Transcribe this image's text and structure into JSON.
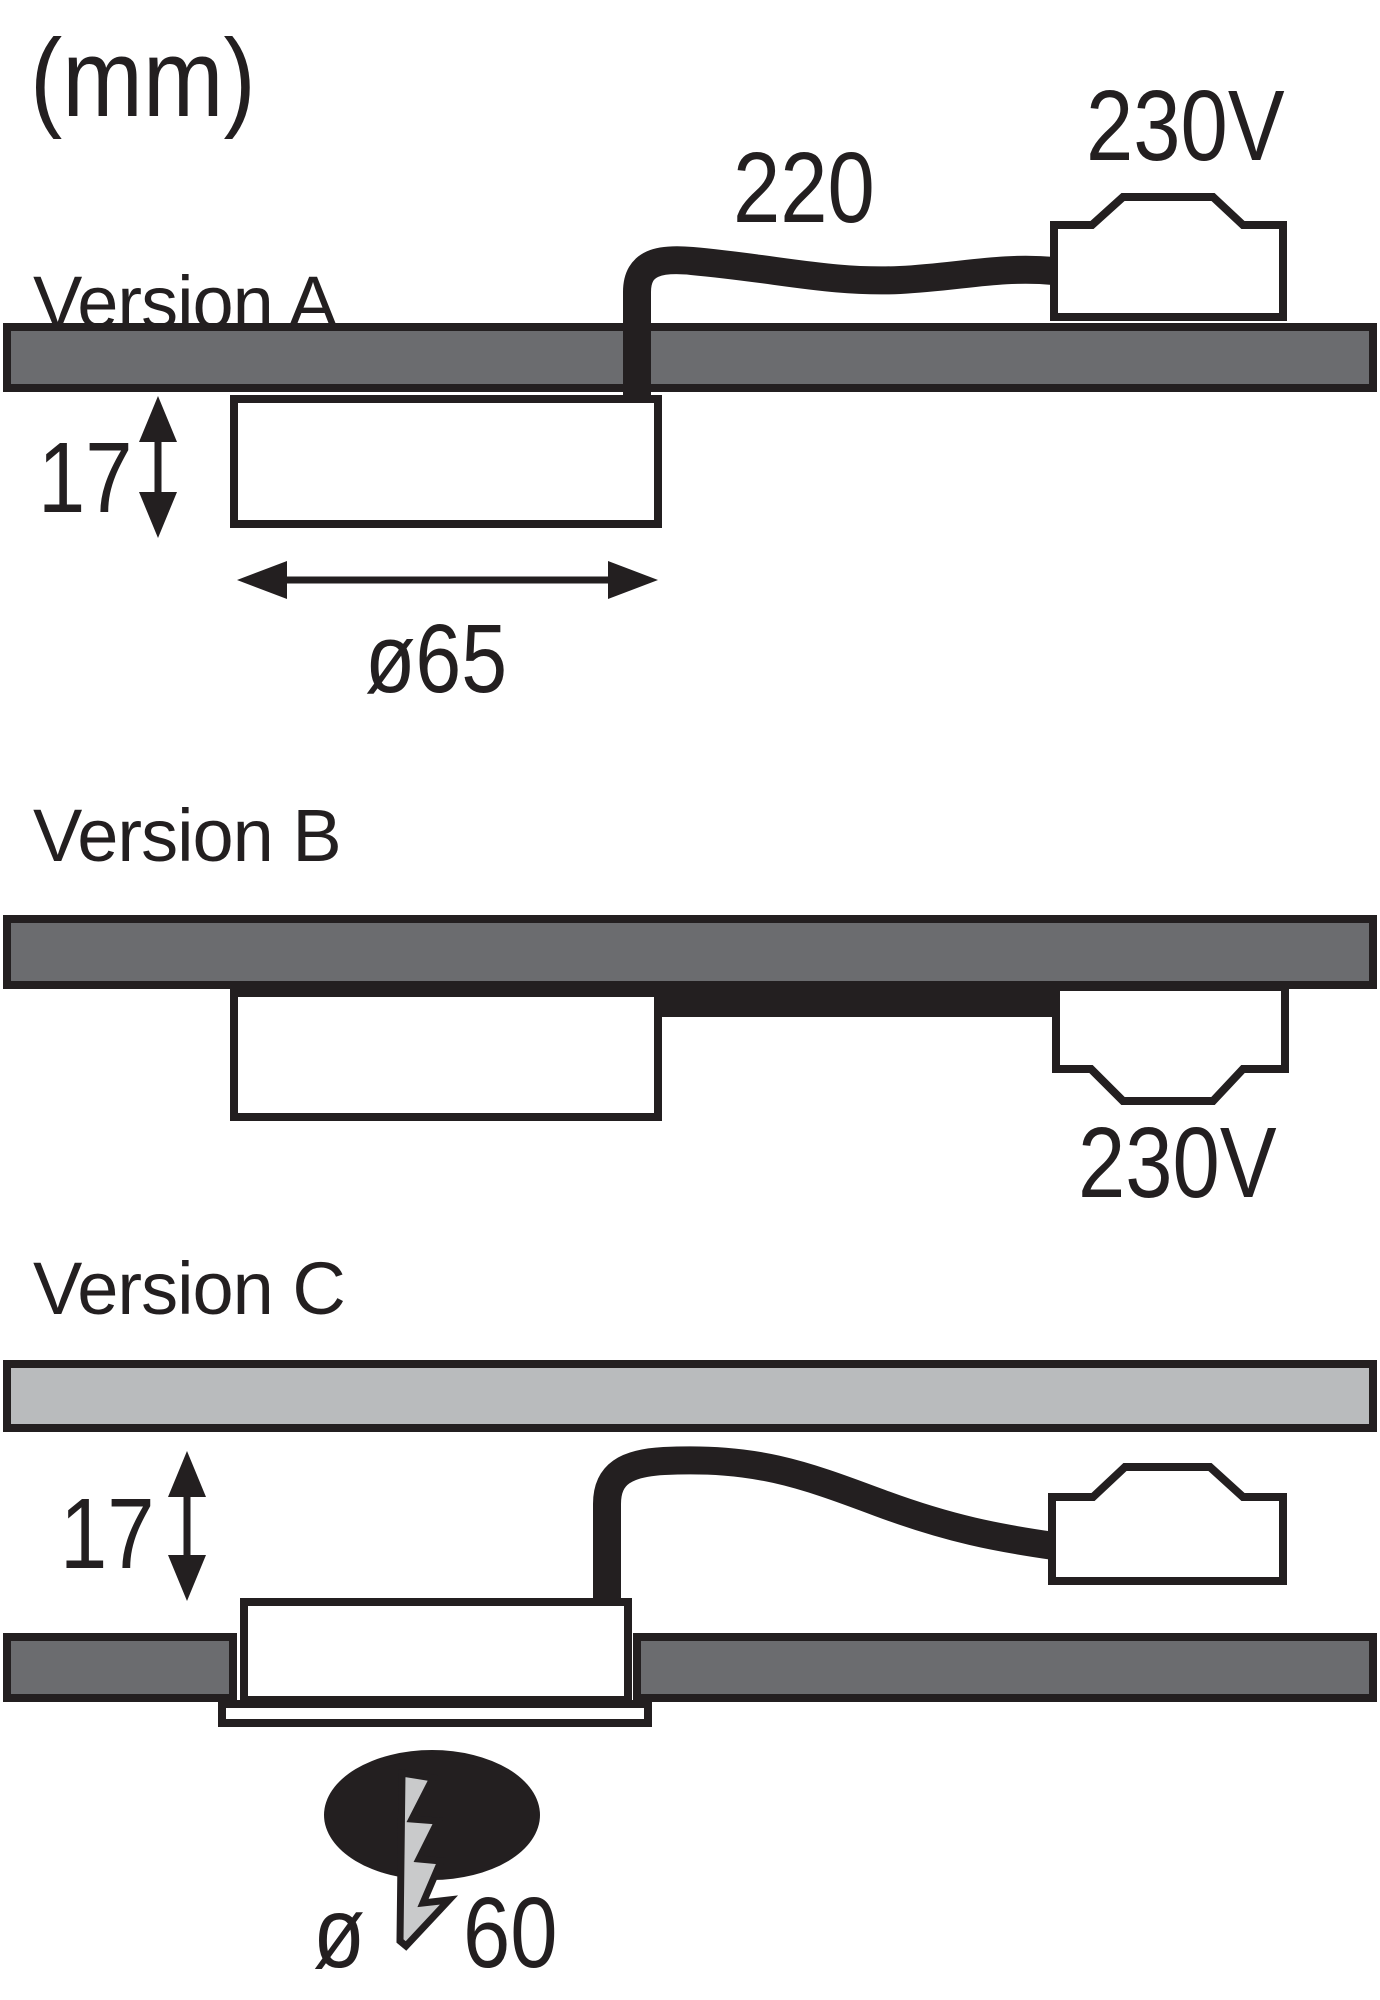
{
  "unit_label": "(mm)",
  "colors": {
    "ink": "#231f20",
    "board-dark": "#6b6c6f",
    "board-light": "#b9bbbd",
    "bolt-fill": "#c9cacb",
    "paper": "#ffffff"
  },
  "versions": {
    "a": {
      "title": "Version A",
      "cable_length": "220",
      "voltage": "230V",
      "recess_depth": "17",
      "diameter": "ø65"
    },
    "b": {
      "title": "Version B",
      "voltage": "230V"
    },
    "c": {
      "title": "Version C",
      "recess_depth": "17",
      "diameter_symbol": "ø",
      "diameter_value": "60"
    }
  }
}
